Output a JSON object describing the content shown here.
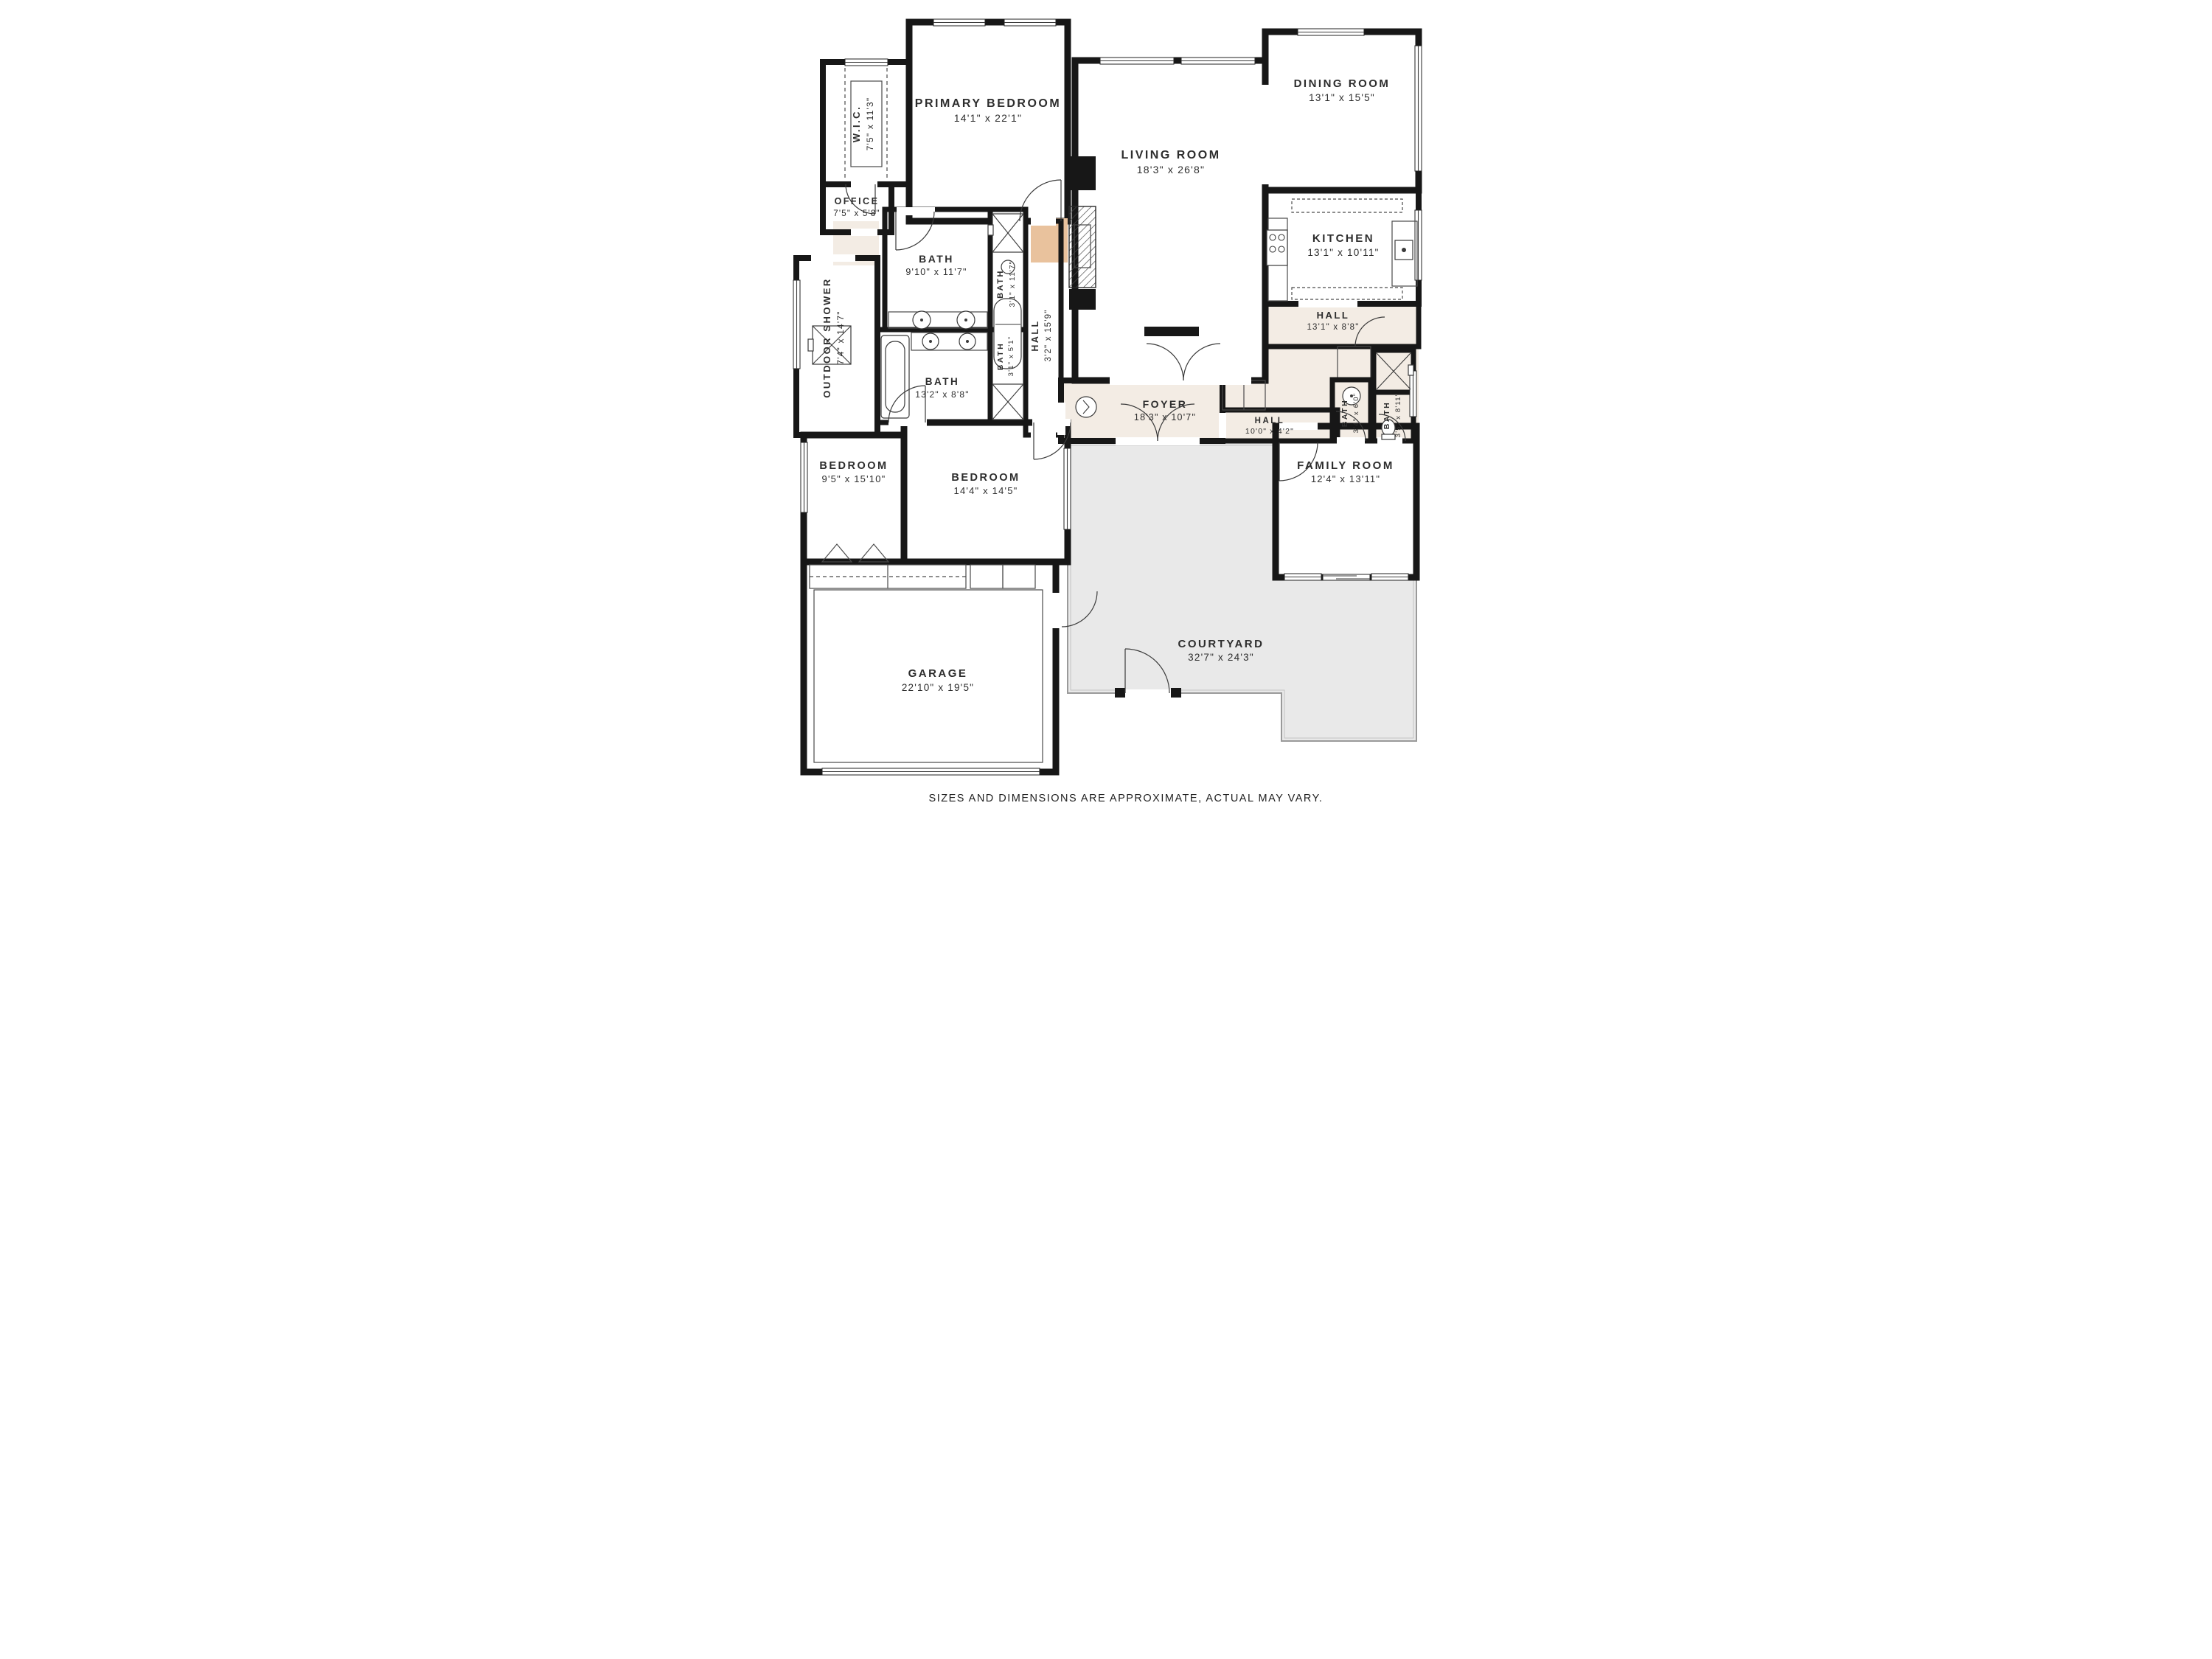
{
  "title": "Floor Plan",
  "footer": {
    "disclaimer": "SIZES AND DIMENSIONS ARE APPROXIMATE, ACTUAL MAY VARY."
  },
  "palette": {
    "wall": "#171717",
    "room_cream": "#f3ece4",
    "bedroom_peach": "#e9c29d",
    "bath_blue": "#cfe0e0",
    "courtyard_gray": "#e9e9e9",
    "text": "#2d2d2d"
  },
  "rooms": [
    {
      "id": "wic",
      "name": "W.I.C.",
      "dims": "7'5\" x 11'3\""
    },
    {
      "id": "office",
      "name": "OFFICE",
      "dims": "7'5\" x 5'8\""
    },
    {
      "id": "primary-bedroom",
      "name": "PRIMARY BEDROOM",
      "dims": "14'1\" x 22'1\""
    },
    {
      "id": "living-room",
      "name": "LIVING ROOM",
      "dims": "18'3\" x 26'8\""
    },
    {
      "id": "dining-room",
      "name": "DINING ROOM",
      "dims": "13'1\" x 15'5\""
    },
    {
      "id": "kitchen",
      "name": "KITCHEN",
      "dims": "13'1\" x 10'11\""
    },
    {
      "id": "hall-upper",
      "name": "HALL",
      "dims": "13'1\" x 8'8\""
    },
    {
      "id": "outdoor-shower",
      "name": "OUTDOOR SHOWER",
      "dims": "7'4\" x 14'7\""
    },
    {
      "id": "bath-main",
      "name": "BATH",
      "dims": "9'10\" x 11'7\""
    },
    {
      "id": "bath-narrow-tall",
      "name": "BATH",
      "dims": "3'1\" x 11'7\""
    },
    {
      "id": "hall-vertical",
      "name": "HALL",
      "dims": "3'2\" x 15'9\""
    },
    {
      "id": "bath-13",
      "name": "BATH",
      "dims": "13'2\" x 8'8\""
    },
    {
      "id": "bath-narrow-short",
      "name": "BATH",
      "dims": "3'1\" x 5'1\""
    },
    {
      "id": "foyer",
      "name": "FOYER",
      "dims": "18'3\" x 10'7\""
    },
    {
      "id": "hall-lower",
      "name": "HALL",
      "dims": "10'0\" x 4'2\""
    },
    {
      "id": "bath-hall-a",
      "name": "BATH",
      "dims": "3'4\" x 6'0\""
    },
    {
      "id": "bath-hall-b",
      "name": "BATH",
      "dims": "3'5\" x 8'11\""
    },
    {
      "id": "family-room",
      "name": "FAMILY ROOM",
      "dims": "12'4\" x 13'11\""
    },
    {
      "id": "bedroom-small",
      "name": "BEDROOM",
      "dims": "9'5\" x 15'10\""
    },
    {
      "id": "bedroom-large",
      "name": "BEDROOM",
      "dims": "14'4\" x 14'5\""
    },
    {
      "id": "garage",
      "name": "GARAGE",
      "dims": "22'10\" x 19'5\""
    },
    {
      "id": "courtyard",
      "name": "COURTYARD",
      "dims": "32'7\" x 24'3\""
    }
  ]
}
